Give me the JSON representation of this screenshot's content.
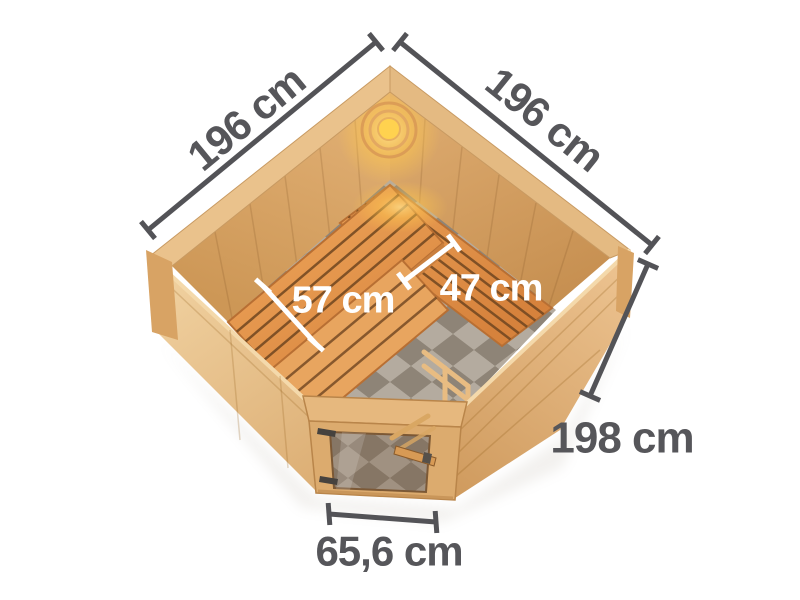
{
  "image": {
    "title": "Corner sauna 196 x 196 cm - top view dimension diagram",
    "background": "#ffffff"
  },
  "dimension_labels": {
    "left_wall": "196 cm",
    "right_wall": "196 cm",
    "bench_left_depth": "57 cm",
    "bench_right_depth": "47 cm",
    "height": "198 cm",
    "door_width": "65,6 cm"
  },
  "colors": {
    "dimension_line": "#535357",
    "dimension_text": "#56565a",
    "inner_dimension_line": "#ffffff",
    "inner_dimension_text": "#ffffff",
    "wood_outer_light": "#f0d2a2",
    "wood_outer_mid": "#deb078",
    "wood_interior": "#d9a768",
    "bench_wood": "#e0914a",
    "bench_gap": "#6e4520",
    "lamp_glow": "#ffd966",
    "floor_tile_light": "#b4ab9f",
    "floor_tile_dark": "#8e8477",
    "glass_tint": "#73553c",
    "hinge_metal": "#46423e"
  }
}
